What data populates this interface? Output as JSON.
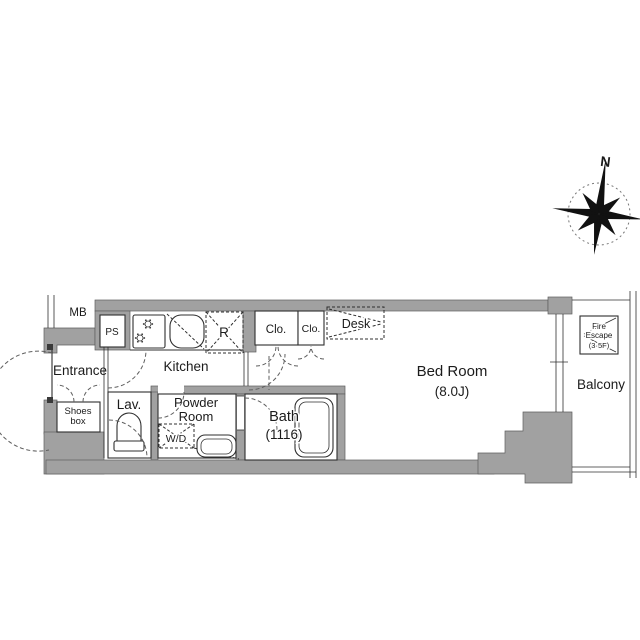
{
  "rooms": {
    "entrance": "Entrance",
    "kitchen": "Kitchen",
    "lavatory": "Lav.",
    "powder_room": [
      "Powder",
      "Room"
    ],
    "bath": [
      "Bath",
      "(1116)"
    ],
    "bed_room": [
      "Bed Room",
      "(8.0J)"
    ],
    "balcony": "Balcony"
  },
  "fixtures": {
    "meter_box": "MB",
    "pipe_space": "PS",
    "refrigerator": "R",
    "closet_left": "Clo.",
    "closet_right": "Clo.",
    "desk": "Desk",
    "shoes_box": [
      "Shoes",
      "box"
    ],
    "washer_dryer": "W/D",
    "fire_escape": [
      "Fire",
      "Escape",
      "(3·5F)"
    ]
  },
  "compass": {
    "north": "N"
  },
  "colors": {
    "wall_fill": "#a1a1a1",
    "wall_edge": "#5e5e5e",
    "line": "#2f2f2f",
    "dashed": "#5f5f5f",
    "background": "#ffffff",
    "text": "#1b1b1b"
  }
}
